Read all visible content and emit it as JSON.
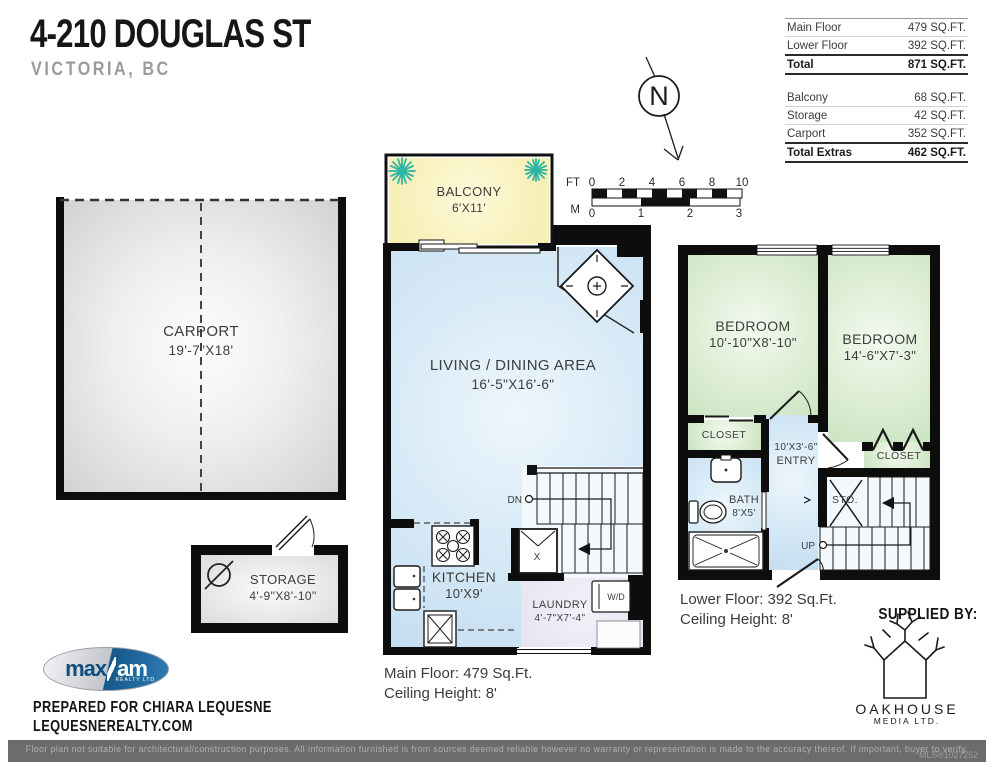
{
  "header": {
    "title": "4-210 DOUGLAS ST",
    "subtitle": "VICTORIA, BC"
  },
  "area_table": {
    "main_rows": [
      {
        "label": "Main Floor",
        "value": "479 SQ.FT."
      },
      {
        "label": "Lower Floor",
        "value": "392 SQ.FT."
      }
    ],
    "total": {
      "label": "Total",
      "value": "871 SQ.FT."
    },
    "extra_rows": [
      {
        "label": "Balcony",
        "value": "68 SQ.FT."
      },
      {
        "label": "Storage",
        "value": "42 SQ.FT."
      },
      {
        "label": "Carport",
        "value": "352 SQ.FT."
      }
    ],
    "total_extras": {
      "label": "Total Extras",
      "value": "462 SQ.FT."
    }
  },
  "compass": {
    "label": "N"
  },
  "scale_bar": {
    "ft_label": "FT",
    "ft_ticks": [
      "0",
      "2",
      "4",
      "6",
      "8",
      "10"
    ],
    "m_label": "M",
    "m_ticks": [
      "0",
      "1",
      "2",
      "3"
    ]
  },
  "rooms": {
    "carport": {
      "name": "CARPORT",
      "dims": "19'-7\"X18'"
    },
    "storage": {
      "name": "STORAGE",
      "dims": "4'-9\"X8'-10\""
    },
    "balcony": {
      "name": "BALCONY",
      "dims": "6'X11'"
    },
    "living": {
      "name": "LIVING / DINING AREA",
      "dims": "16'-5\"X16'-6\""
    },
    "kitchen": {
      "name": "KITCHEN",
      "dims": "10'X9'"
    },
    "laundry": {
      "name": "LAUNDRY",
      "dims": "4'-7\"X7'-4\""
    },
    "bedroom1": {
      "name": "BEDROOM",
      "dims": "10'-10\"X8'-10\""
    },
    "bedroom2": {
      "name": "BEDROOM",
      "dims": "14'-6\"X7'-3\""
    },
    "closet1": {
      "name": "CLOSET"
    },
    "closet2": {
      "name": "CLOSET"
    },
    "entry": {
      "dims": "10'X3'-6\"",
      "name": "ENTRY"
    },
    "bath": {
      "name": "BATH",
      "dims": "8'X5'"
    },
    "sto": {
      "name": "STO."
    }
  },
  "stairs": {
    "down_label": "DN",
    "up_label": "UP"
  },
  "appliances": {
    "washer_dryer": "W/D",
    "furnace": "X"
  },
  "floor_notes": {
    "main_line1": "Main Floor: 479 Sq.Ft.",
    "main_line2": "Ceiling Height: 8'",
    "lower_line1": "Lower Floor: 392 Sq.Ft.",
    "lower_line2": "Ceiling Height: 8'"
  },
  "branding": {
    "prepared_for": "PREPARED FOR CHIARA LEQUESNE",
    "website": "LEQUESNEREALTY.COM",
    "realty_logo": {
      "part1": "max",
      "part2": "am",
      "tagline": "REALTY LTD"
    },
    "supplied_by": "SUPPLIED BY:",
    "media_logo": {
      "line1": "OAKHOUSE",
      "line2": "MEDIA LTD."
    }
  },
  "footer": {
    "disclaimer": "Floor plan not suitable for architectural/construction purposes. All information furnished is from sources deemed reliable however no warranty or representation is made to the accuracy thereof. If important, buyer to verify.",
    "mls": "MLS®1027252"
  },
  "colors": {
    "room_blue": "#cde3f3",
    "room_green": "#d5e9cd",
    "room_yellow": "#f7f0b8",
    "room_lavender": "#e9e7f3",
    "carport_gray": "#d4d4d4",
    "wall_black": "#0d0d0d",
    "plant_teal": "#2fb5a3",
    "footer_gray": "#6c6c6c"
  }
}
